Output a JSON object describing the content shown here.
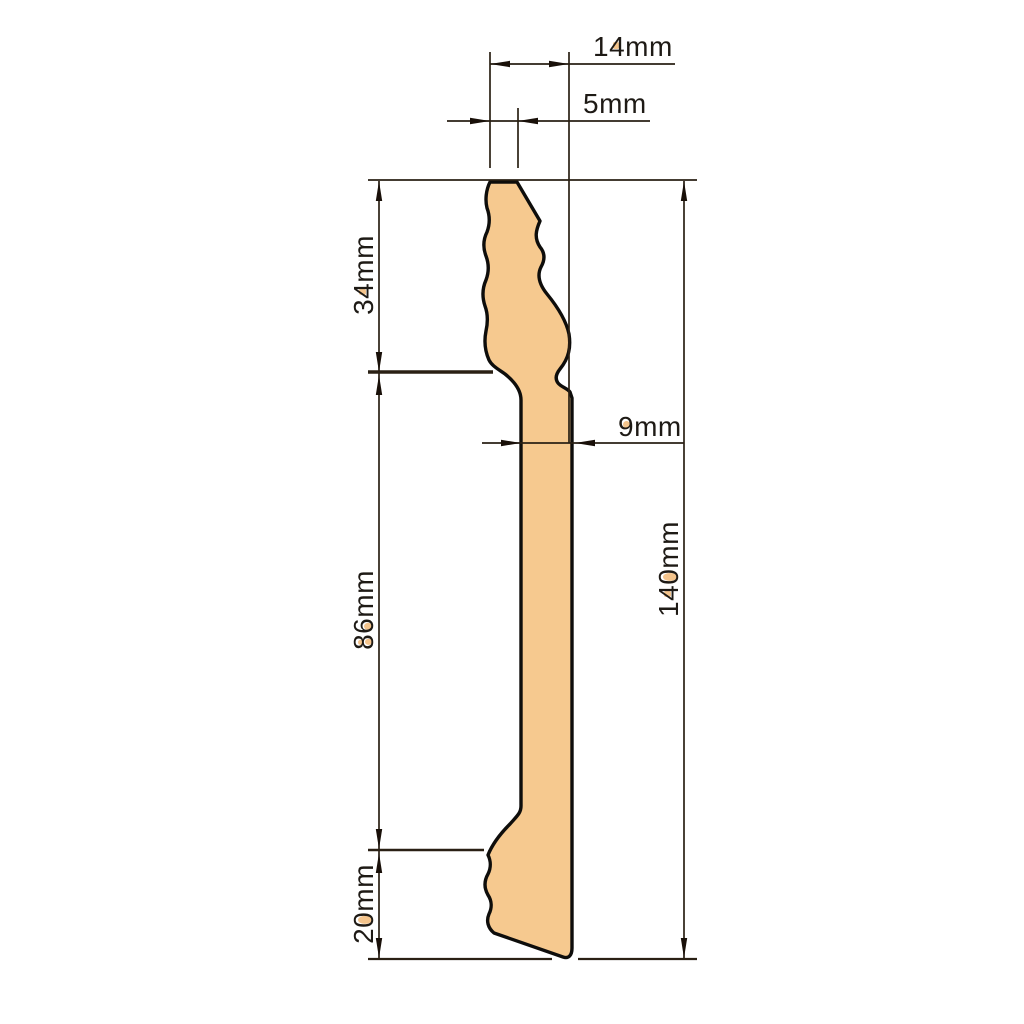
{
  "drawing": {
    "subject": "skirting-board-profile-cross-section",
    "unit": "mm",
    "colors": {
      "profile_fill": "#F6C98F",
      "profile_outline": "#0E0D0B",
      "dimension_lines": "#2A2014",
      "text": "#1E1A15"
    },
    "dims": {
      "d14": {
        "label": "14mm",
        "value": 14,
        "orientation": "horizontal",
        "role": "top-overall-depth"
      },
      "d5": {
        "label": "5mm",
        "value": 5,
        "orientation": "horizontal",
        "role": "top-edge-depth"
      },
      "d34": {
        "label": "34mm",
        "value": 34,
        "orientation": "vertical",
        "role": "top-moulded-section-height"
      },
      "d9": {
        "label": "9mm",
        "value": 9,
        "orientation": "horizontal",
        "role": "body-thickness"
      },
      "d86": {
        "label": "86mm",
        "value": 86,
        "orientation": "vertical",
        "role": "middle-flat-section-height"
      },
      "d140": {
        "label": "140mm",
        "value": 140,
        "orientation": "vertical",
        "role": "total-height"
      },
      "d20": {
        "label": "20mm",
        "value": 20,
        "orientation": "vertical",
        "role": "bottom-section-height"
      }
    }
  }
}
